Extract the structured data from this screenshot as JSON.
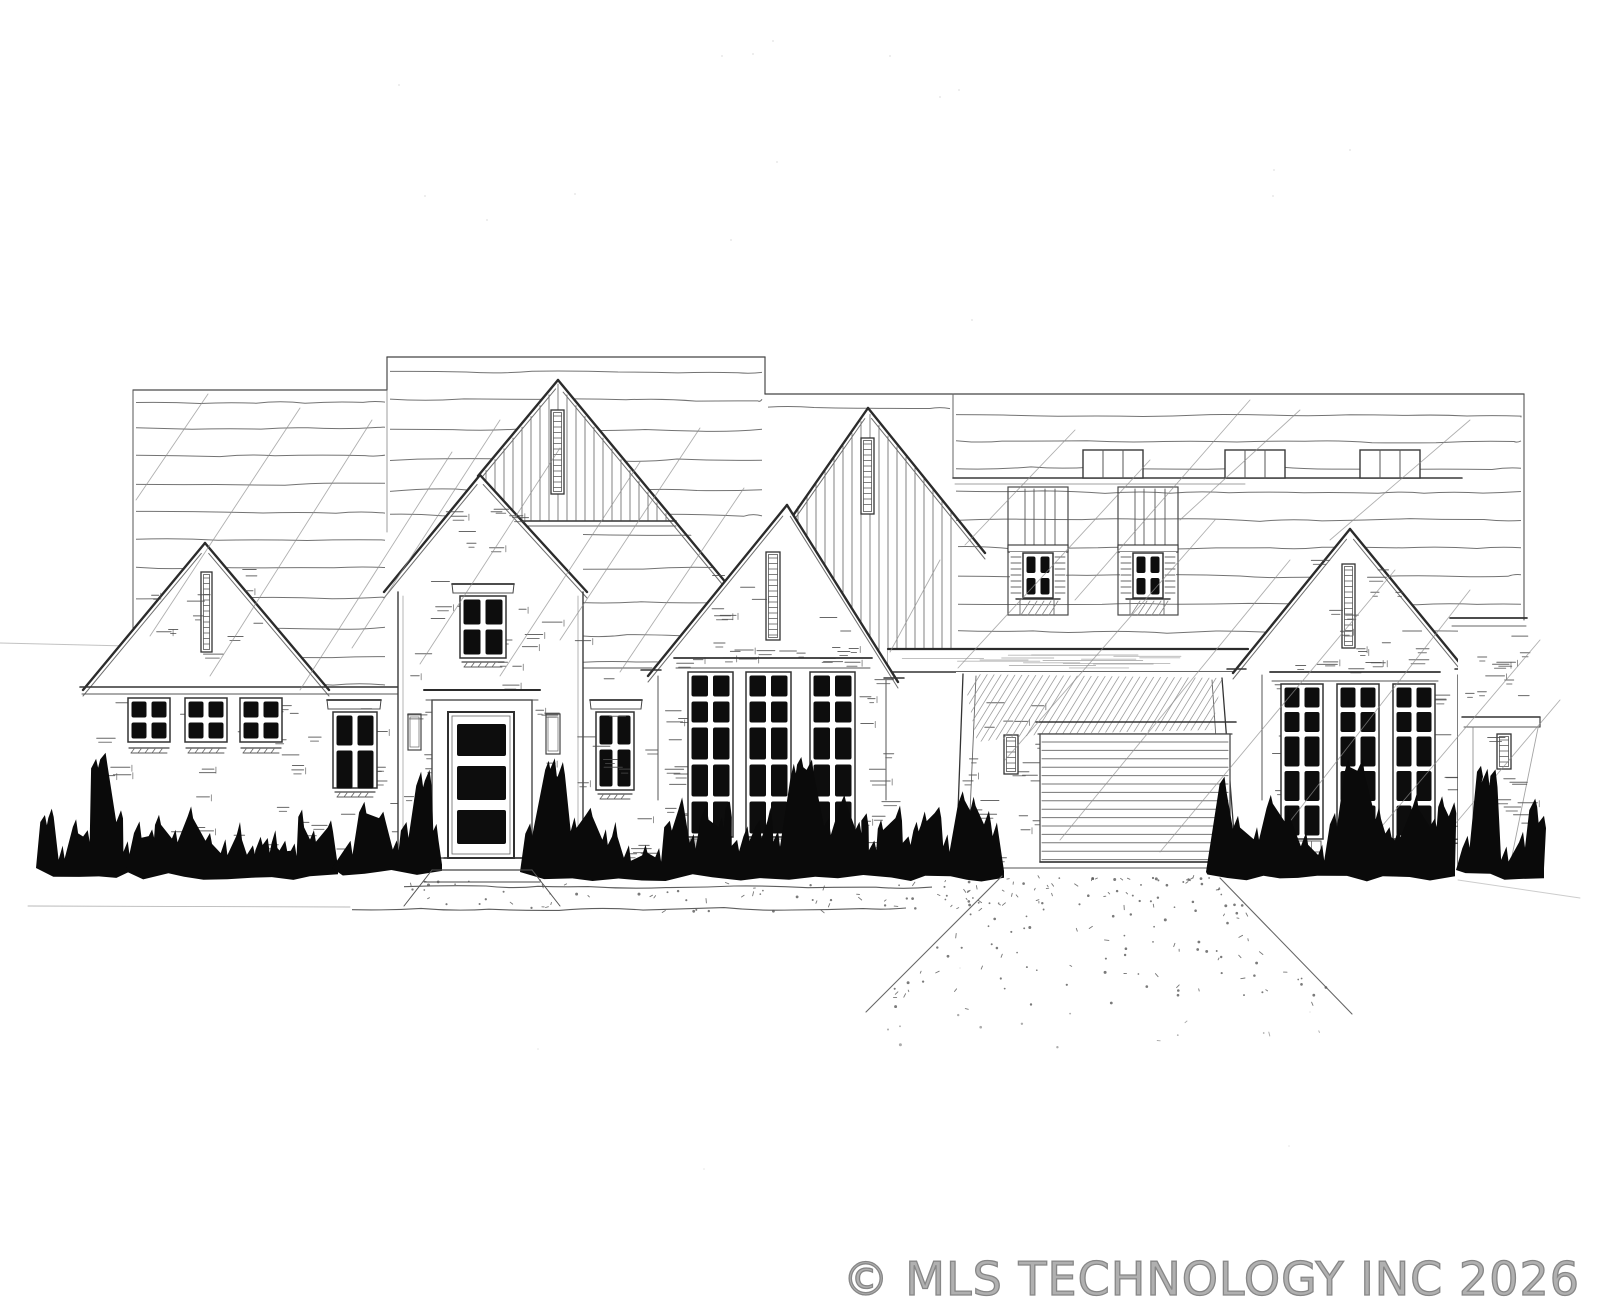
{
  "scene": {
    "alt": "Black-and-white hand-drawn architectural front elevation sketch of a large gabled house: brick walls, board-and-batten gable peaks with slit vents, tall multi-pane black windows, a three-lite entry door, a recessed garage with horizontal-slat door, chimneys on the rear roofline, dark hedge silhouettes along the foundation, and a stippled walkway and driveway"
  },
  "watermark": {
    "text": "© MLS TECHNOLOGY INC 2026",
    "color": "#8f8f8f"
  },
  "palette": {
    "paper": "#ffffff",
    "ink": "#2f2f2f",
    "ink_medium": "#555555",
    "pencil": "#8a8a8a",
    "glass": "#0d0d0d",
    "shrub": "#0a0a0a"
  }
}
